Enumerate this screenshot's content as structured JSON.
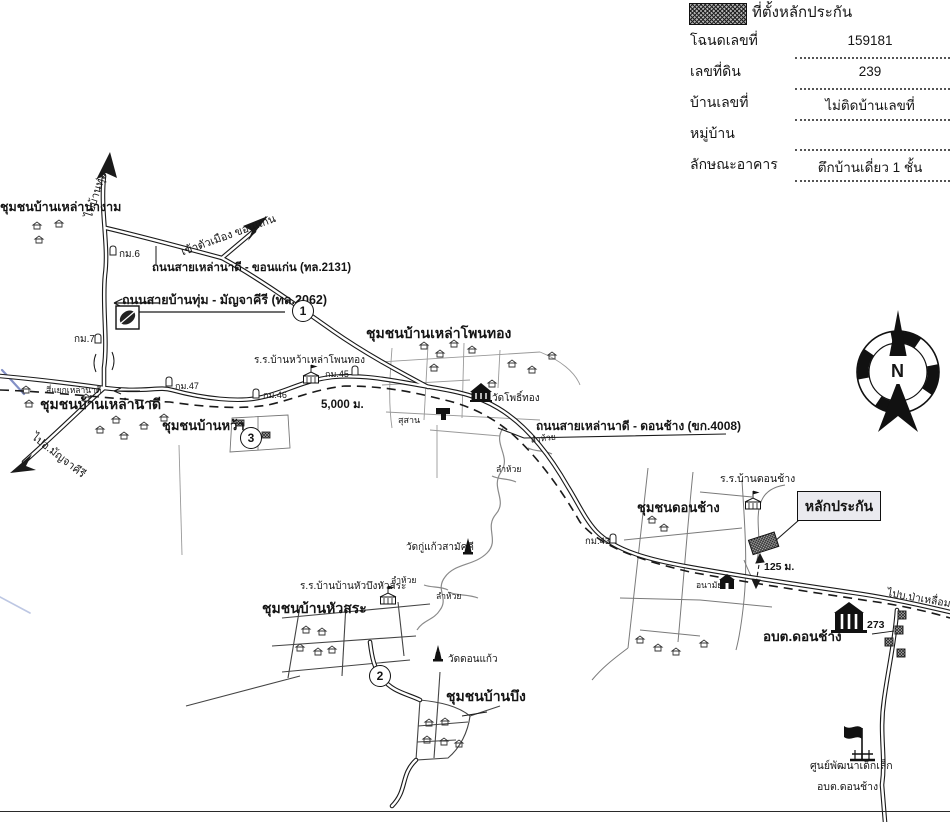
{
  "legend": {
    "title": "ที่ตั้งหลักประกัน",
    "fields": [
      {
        "label": "โฉนดเลขที่",
        "value": "159181"
      },
      {
        "label": "เลขที่ดิน",
        "value": "239"
      },
      {
        "label": "บ้านเลขที่",
        "value": "ไม่ติดบ้านเลขที่"
      },
      {
        "label": "หมู่บ้าน",
        "value": ""
      },
      {
        "label": "ลักษณะอาคาร",
        "value": "ตึกบ้านเดี่ยว 1 ชั้น"
      }
    ]
  },
  "compass": {
    "north": "N"
  },
  "map": {
    "collateral_label": "หลักประกัน",
    "communities": {
      "lao_na_ngam": "ชุมชนบ้านเหล่านางาม",
      "lao_na_di": "ชุมชนบ้านเหล่านาดี",
      "ban_wa": "ชุมชนบ้านหว้า",
      "lao_phon_thong": "ชุมชนบ้านเหล่าโพนทอง",
      "don_chang": "ชุมชนดอนช้าง",
      "hua_sa": "ชุมชนบ้านหัวสระ",
      "ban_bueng": "ชุมชนบ้านบึง"
    },
    "roads": {
      "r2131": "ถนนสายเหล่านาดี - ขอนแก่น (ทล.2131)",
      "r2062": "ถนนสายบ้านทุ่ม - มัญจาคีรี (ทล.2062)",
      "r4008": "ถนนสายเหล่านาดี - ดอนช้าง (ขก.4008)"
    },
    "directions": {
      "to_ban_thum": "ไปบ้านทุ่ม",
      "to_khon_kaen": "เข้าตัวเมือง ขอนแก่น",
      "to_manchakhiri": "ไปอ.มัญจาคีรี",
      "to_pa_lueam": "ไปบ.ป่าเหลื่อม"
    },
    "places": {
      "junction": "สี่แยกเหล่านาดี",
      "school_wa_lao_phon_thong": "ร.ร.บ้านหว้าเหล่าโพนทอง",
      "wat_pho_thong": "วัดโพธิ์ทอง",
      "cemetery": "สุสาน",
      "school_don_chang": "ร.ร.บ้านดอนช้าง",
      "health_center": "อนามัย",
      "sao_don_chang": "อบต.ดอนช้าง",
      "wat_ku_kaeo": "วัดกู่แก้วสามัคคี",
      "school_hua_bueng_hua_sa": "ร.ร.บ้านบ้านหัวบึงหัวสระ",
      "wat_don_kaeo": "วัดดอนแก้ว",
      "child_center_line1": "ศูนย์พัฒนาเด็กเล็ก",
      "child_center_line2": "อบต.ดอนช้าง",
      "stream": "ลำห้วย"
    },
    "markers": {
      "km6": "กม.6",
      "km7": "กม.7",
      "km43": "กม.43",
      "km45": "กม.45",
      "km46": "กม.46",
      "km47": "กม.47",
      "distance_5000": "5,000 ม.",
      "distance_125": "125 ม.",
      "route_273": "273"
    },
    "circled_numbers": [
      "1",
      "2",
      "3"
    ]
  }
}
